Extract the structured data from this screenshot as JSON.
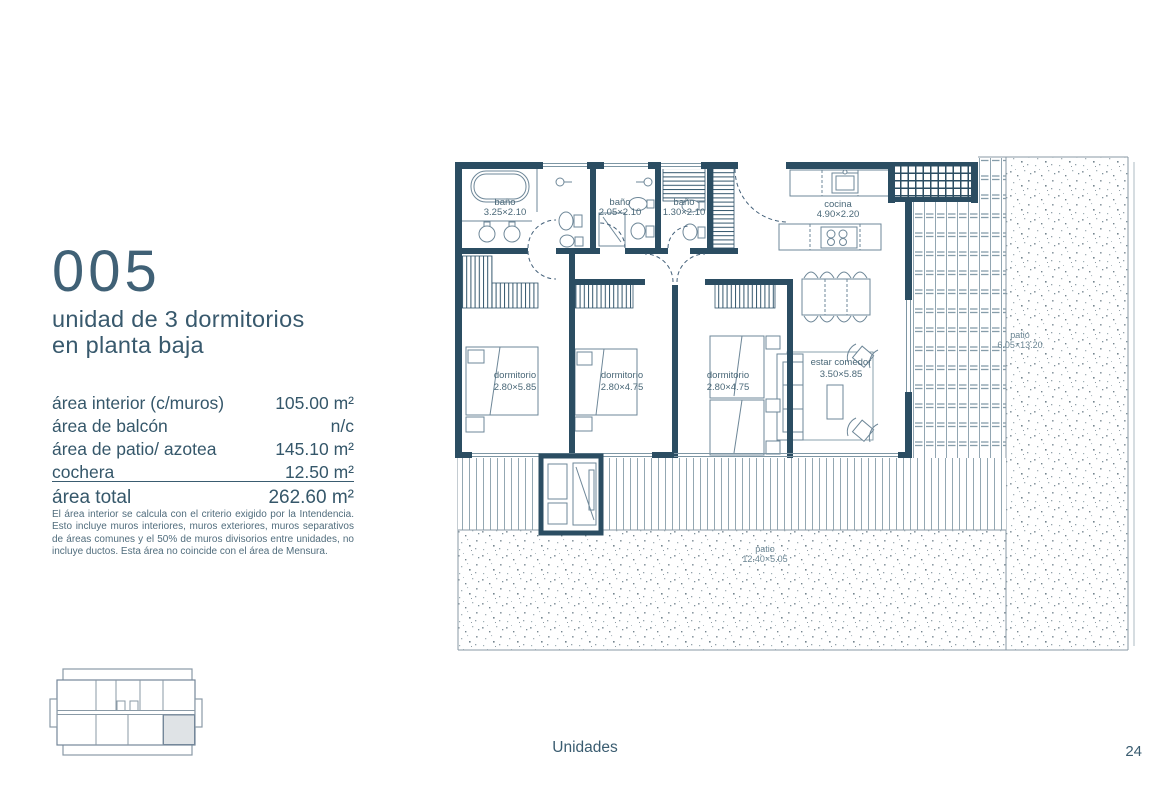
{
  "header": {
    "unit_number": "005",
    "subtitle_line1": "unidad de 3 dormitorios",
    "subtitle_line2": "en planta baja"
  },
  "areas": {
    "rows": [
      {
        "label": "área interior (c/muros)",
        "value": "105.00 m²"
      },
      {
        "label": "área de balcón",
        "value": "n/c"
      },
      {
        "label": "área de patio/ azotea",
        "value": "145.10 m²"
      },
      {
        "label": "cochera",
        "value": "12.50 m²"
      }
    ],
    "total_label": "área total",
    "total_value": "262.60 m²",
    "disclaimer": "El área interior se calcula con el criterio exigido por la Intendencia. Esto incluye muros interiores, muros exteriores, muros separativos de áreas comunes y el 50% de muros divisorios entre unidades, no incluye ductos. Esta área no coincide con el área de Mensura."
  },
  "plan": {
    "rooms": {
      "bano1": {
        "name": "baño",
        "dims": "3.25×2.10"
      },
      "bano2": {
        "name": "baño",
        "dims": "2.05×2.10"
      },
      "bano3": {
        "name": "baño",
        "dims": "1.30×2.10"
      },
      "cocina": {
        "name": "cocina",
        "dims": "4.90×2.20"
      },
      "dorm1": {
        "name": "dormitorio",
        "dims": "2.80×5.85"
      },
      "dorm2": {
        "name": "dormitorio",
        "dims": "2.80×4.75"
      },
      "dorm3": {
        "name": "dormitorio",
        "dims": "2.80×4.75"
      },
      "estar": {
        "name": "estar comedor",
        "dims": "3.50×5.85"
      },
      "patio_right": {
        "name": "patio",
        "dims": "6.05×13.20"
      },
      "patio_bottom": {
        "name": "patio",
        "dims": "12.40×5.05"
      }
    }
  },
  "footer": {
    "section": "Unidades",
    "page_number": "24"
  },
  "colors": {
    "ink": "#2b4d62",
    "text": "#35576a",
    "light_line": "#93a7b2",
    "key_plan_highlight": "#dfe3e6"
  }
}
